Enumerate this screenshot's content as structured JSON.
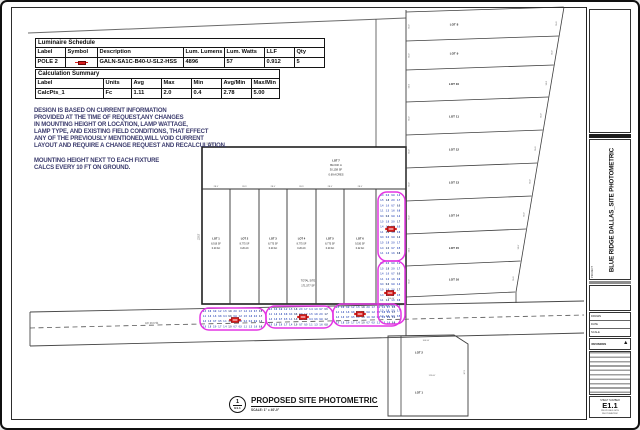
{
  "colors": {
    "line": "#4a4a4a",
    "heavy_line": "#1f1f1f",
    "magenta": "#e335e3",
    "fixture_red": "#d81d1d",
    "calc_blue": "#2a47b8",
    "calc_blue_dark": "#16306e",
    "notes_ink": "#3b3b6d"
  },
  "luminaire_schedule": {
    "title": "Luminaire Schedule",
    "columns": [
      "Label",
      "Symbol",
      "Description",
      "Lum. Lumens",
      "Lum. Watts",
      "LLF",
      "Qty"
    ],
    "rows": [
      [
        "POLE 2",
        "@sym",
        "GALN-SA1C-B40-U-SL2-HSS",
        "4896",
        "57",
        "0.912",
        "5"
      ]
    ]
  },
  "calculation_summary": {
    "title": "Calculation Summary",
    "columns": [
      "Label",
      "Units",
      "Avg",
      "Max",
      "Min",
      "Avg/Min",
      "Max/Min"
    ],
    "rows": [
      [
        "CalcPts_1",
        "Fc",
        "1.11",
        "2.0",
        "0.4",
        "2.78",
        "5.00"
      ]
    ]
  },
  "notes": [
    "DESIGN IS BASED ON CURRENT INFORMATION",
    "PROVIDED AT THE TIME OF REQUEST,ANY CHANGES",
    "IN MOUNTING HEIGHT OR LOCATION, LAMP WATTAGE,",
    "LAMP TYPE, AND EXISTING FIELD CONDITIONS, THAT EFFECT",
    "ANY OF THE PREVIOUSLY MENTIONED,WILL VOID CURRENT",
    "LAYOUT AND REQUIRE A CHANGE REQUEST AND RECALCULATION.",
    "",
    "MOUNTING HEIGHT NEXT TO EACH FIXTURE",
    "CALCS EVERY 10 FT ON GROUND."
  ],
  "drawing_label": {
    "detail_number": "1",
    "sheet_ref": "E1.1",
    "title": "PROPOSED SITE PHOTOMETRIC",
    "scale": "SCALE: 1\" = 40'-0\""
  },
  "title_block": {
    "project_label": "PROJECT",
    "project_title": "BLUE RIDGE DALLAS_SITE PHOTOMETRIC",
    "field_rows": [
      {
        "label": "DRAWN",
        "value": ""
      },
      {
        "label": "DATE",
        "value": ""
      },
      {
        "label": "SCALE",
        "value": ""
      }
    ],
    "revision_label": "REVISIONS",
    "sheet_number_label": "SHEET NUMBER",
    "sheet_number": "E1.1",
    "sheet_caption_lines": [
      "PROPOSED SITE",
      "PHOTOMETRIC"
    ]
  },
  "site_plan": {
    "top_lot_lines": [
      "LOT 7",
      "BLOCK A",
      "30,158 SF",
      "0.69 ACRES"
    ],
    "center_lots": [
      {
        "label": "LOT 1",
        "area": "8,919 SF",
        "acres": "0.20 AC"
      },
      {
        "label": "LOT 2",
        "area": "8,775 SF",
        "acres": "0.20 AC"
      },
      {
        "label": "LOT 3",
        "area": "8,775 SF",
        "acres": "0.20 AC"
      },
      {
        "label": "LOT 4",
        "area": "8,775 SF",
        "acres": "0.20 AC"
      },
      {
        "label": "LOT 5",
        "area": "8,775 SF",
        "acres": "0.20 AC"
      },
      {
        "label": "LOT 6",
        "area": "9,530 SF",
        "acres": "0.22 AC"
      }
    ],
    "total_label_lines": [
      "TOTAL SITE",
      "171,577 SF"
    ],
    "east_lots": [
      "LOT 8",
      "LOT 9",
      "LOT 10",
      "LOT 11",
      "LOT 12",
      "LOT 13",
      "LOT 14",
      "LOT 15",
      "LOT 16"
    ],
    "parcel_lots": [
      "LOT 2",
      "LOT 1"
    ],
    "road_label": "60' R.O.W.",
    "dims": {
      "corner": "56.25'",
      "lot_width": "28.5'",
      "left_depth": "120.0'",
      "strip_depth": "55.0'",
      "road_width": "150.00'",
      "parcel_top": "104.96'",
      "parcel_mid": "125.00'",
      "parcel_side": "87.5'"
    },
    "calc_values": [
      "0.4",
      "0.6",
      "0.9",
      "1.2",
      "1.5",
      "1.8",
      "2.0",
      "1.7",
      "1.4",
      "1.0",
      "0.7",
      "0.5",
      "1.1",
      "1.3",
      "1.6",
      "0.8"
    ],
    "fixture_count": 5
  }
}
